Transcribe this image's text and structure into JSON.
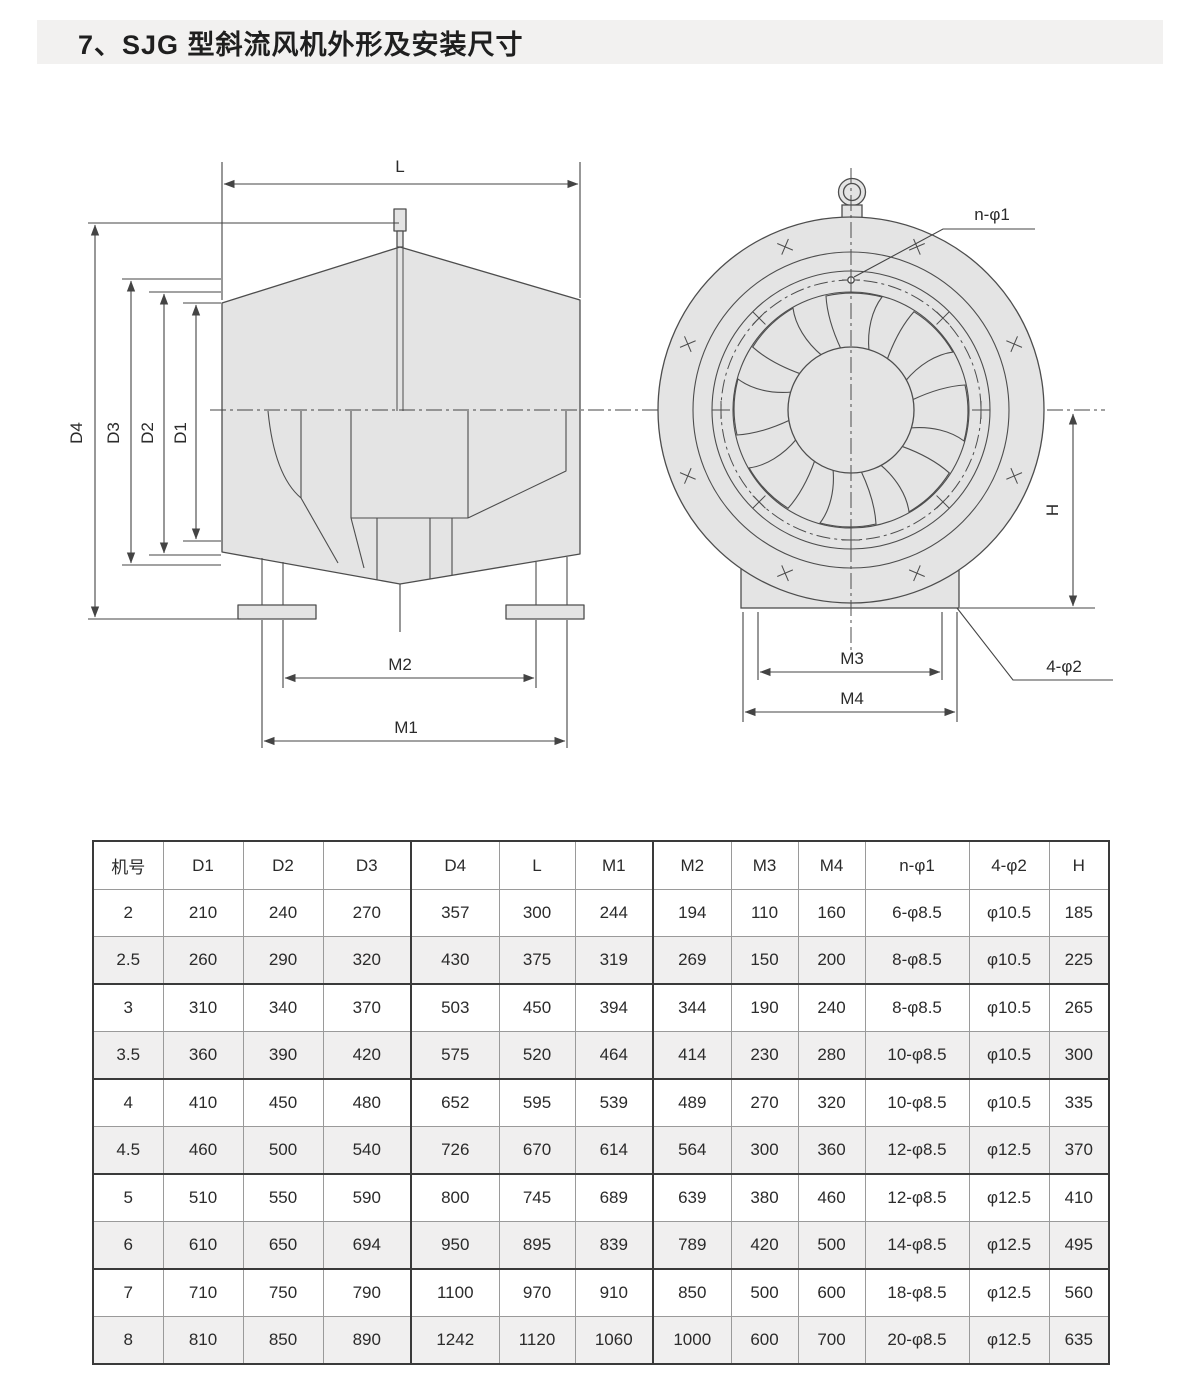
{
  "page": {
    "title": "7、SJG 型斜流风机外形及安装尺寸"
  },
  "drawing": {
    "colors": {
      "body_fill": "#e4e4e4",
      "line": "#4d4d4d",
      "dim_line": "#444444"
    },
    "side_view": {
      "labels": {
        "l": "L",
        "d4": "D4",
        "d3": "D3",
        "d2": "D2",
        "d1": "D1",
        "m2": "M2",
        "m1": "M1"
      }
    },
    "front_view": {
      "labels": {
        "n_phi1": "n-φ1",
        "h": "H",
        "m3": "M3",
        "m4": "M4",
        "four_phi2": "4-φ2"
      }
    }
  },
  "table": {
    "headers": [
      "机号",
      "D1",
      "D2",
      "D3",
      "D4",
      "L",
      "M1",
      "M2",
      "M3",
      "M4",
      "n-φ1",
      "4-φ2",
      "H"
    ],
    "rows": [
      [
        "2",
        "210",
        "240",
        "270",
        "357",
        "300",
        "244",
        "194",
        "110",
        "160",
        "6-φ8.5",
        "φ10.5",
        "185"
      ],
      [
        "2.5",
        "260",
        "290",
        "320",
        "430",
        "375",
        "319",
        "269",
        "150",
        "200",
        "8-φ8.5",
        "φ10.5",
        "225"
      ],
      [
        "3",
        "310",
        "340",
        "370",
        "503",
        "450",
        "394",
        "344",
        "190",
        "240",
        "8-φ8.5",
        "φ10.5",
        "265"
      ],
      [
        "3.5",
        "360",
        "390",
        "420",
        "575",
        "520",
        "464",
        "414",
        "230",
        "280",
        "10-φ8.5",
        "φ10.5",
        "300"
      ],
      [
        "4",
        "410",
        "450",
        "480",
        "652",
        "595",
        "539",
        "489",
        "270",
        "320",
        "10-φ8.5",
        "φ10.5",
        "335"
      ],
      [
        "4.5",
        "460",
        "500",
        "540",
        "726",
        "670",
        "614",
        "564",
        "300",
        "360",
        "12-φ8.5",
        "φ12.5",
        "370"
      ],
      [
        "5",
        "510",
        "550",
        "590",
        "800",
        "745",
        "689",
        "639",
        "380",
        "460",
        "12-φ8.5",
        "φ12.5",
        "410"
      ],
      [
        "6",
        "610",
        "650",
        "694",
        "950",
        "895",
        "839",
        "789",
        "420",
        "500",
        "14-φ8.5",
        "φ12.5",
        "495"
      ],
      [
        "7",
        "710",
        "750",
        "790",
        "1100",
        "970",
        "910",
        "850",
        "500",
        "600",
        "18-φ8.5",
        "φ12.5",
        "560"
      ],
      [
        "8",
        "810",
        "850",
        "890",
        "1242",
        "1120",
        "1060",
        "1000",
        "600",
        "700",
        "20-φ8.5",
        "φ12.5",
        "635"
      ]
    ]
  }
}
